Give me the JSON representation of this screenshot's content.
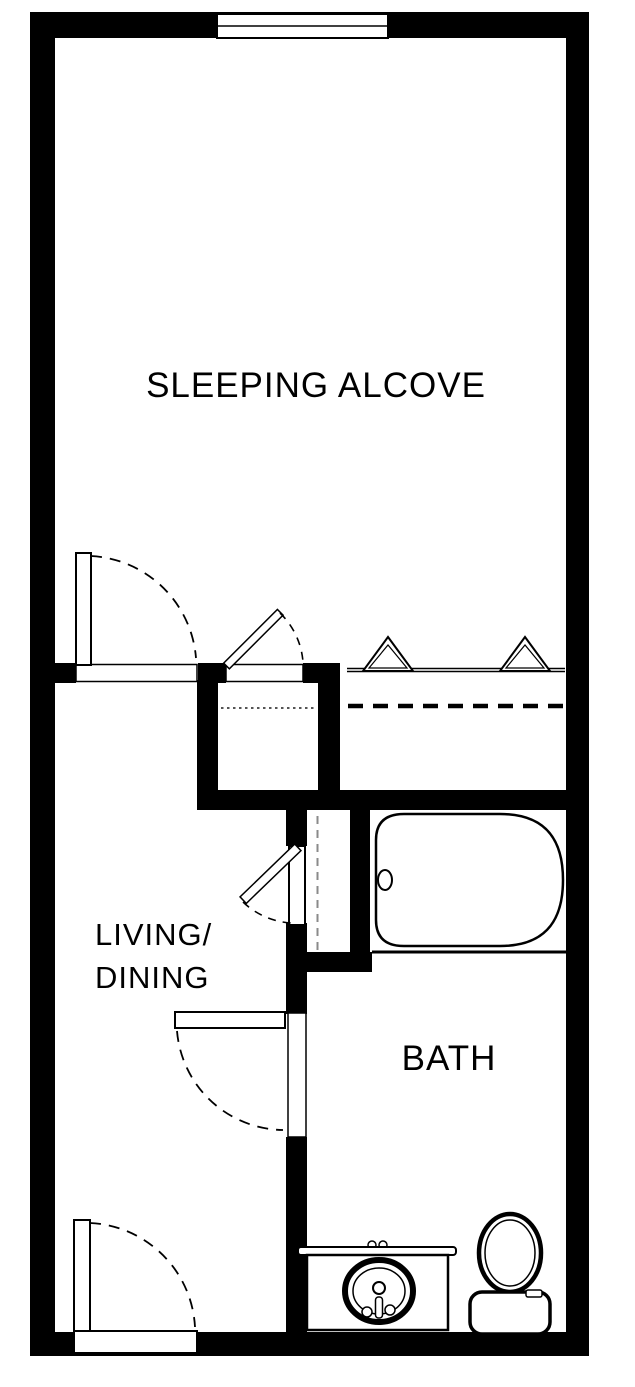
{
  "colors": {
    "wall": "#000000",
    "background": "#ffffff",
    "line": "#000000",
    "dash_gray": "#8a8a8a"
  },
  "floorplan": {
    "type": "studio-apartment-floor-plan",
    "rooms": {
      "sleeping_alcove": {
        "label": "SLEEPING ALCOVE"
      },
      "living_dining": {
        "label_line1": "LIVING/",
        "label_line2": "DINING"
      },
      "bath": {
        "label": "BATH"
      }
    },
    "fixtures": {
      "window": "window",
      "bathtub": "bathtub-with-drain",
      "sink_vanity": "vanity-with-oval-sink-and-faucet",
      "toilet": "toilet-with-tank",
      "closet_rods": [
        "large-closet-rod-dashed",
        "small-closet-rod-dotted"
      ],
      "doors": [
        "sleeping-alcove-swing-door",
        "small-closet-swing-door",
        "closet-bifold-door-left",
        "closet-bifold-door-right",
        "linen-closet-swing-door",
        "bath-swing-door",
        "entry-swing-door"
      ]
    }
  }
}
